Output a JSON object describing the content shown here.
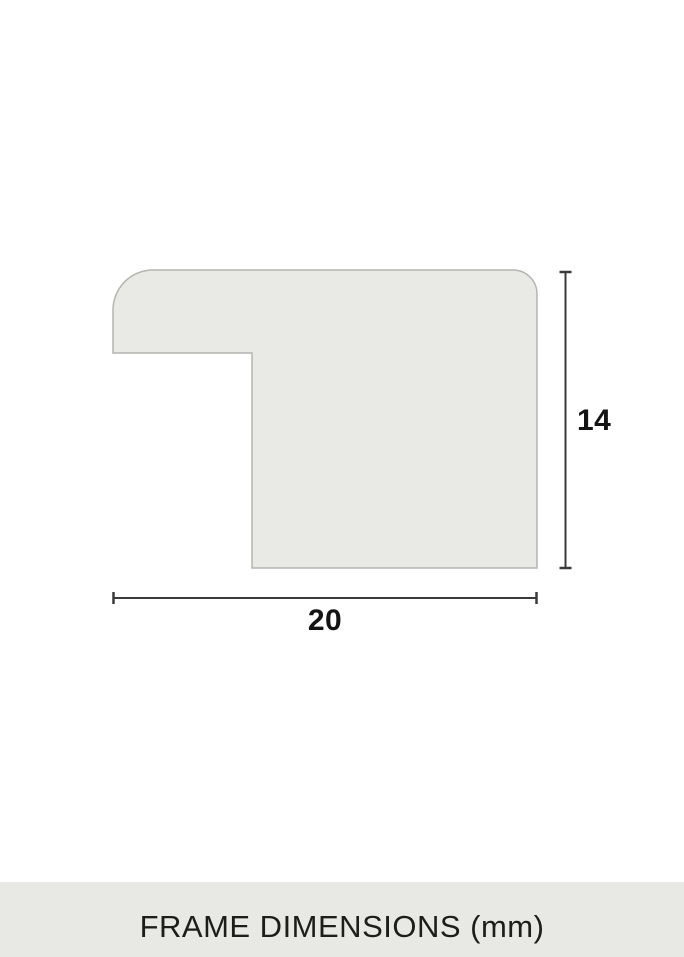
{
  "diagram": {
    "profile": {
      "fill": "#e9e9e6",
      "stroke": "#b4b4b1"
    },
    "dimensions": {
      "line_color": "#3a3a3a",
      "label_color": "#141414",
      "height": {
        "value": "14"
      },
      "width": {
        "value": "20"
      }
    },
    "caption": {
      "text": "FRAME DIMENSIONS (mm)",
      "background": "#e8e8e4",
      "text_color": "#1d1d1b"
    }
  }
}
